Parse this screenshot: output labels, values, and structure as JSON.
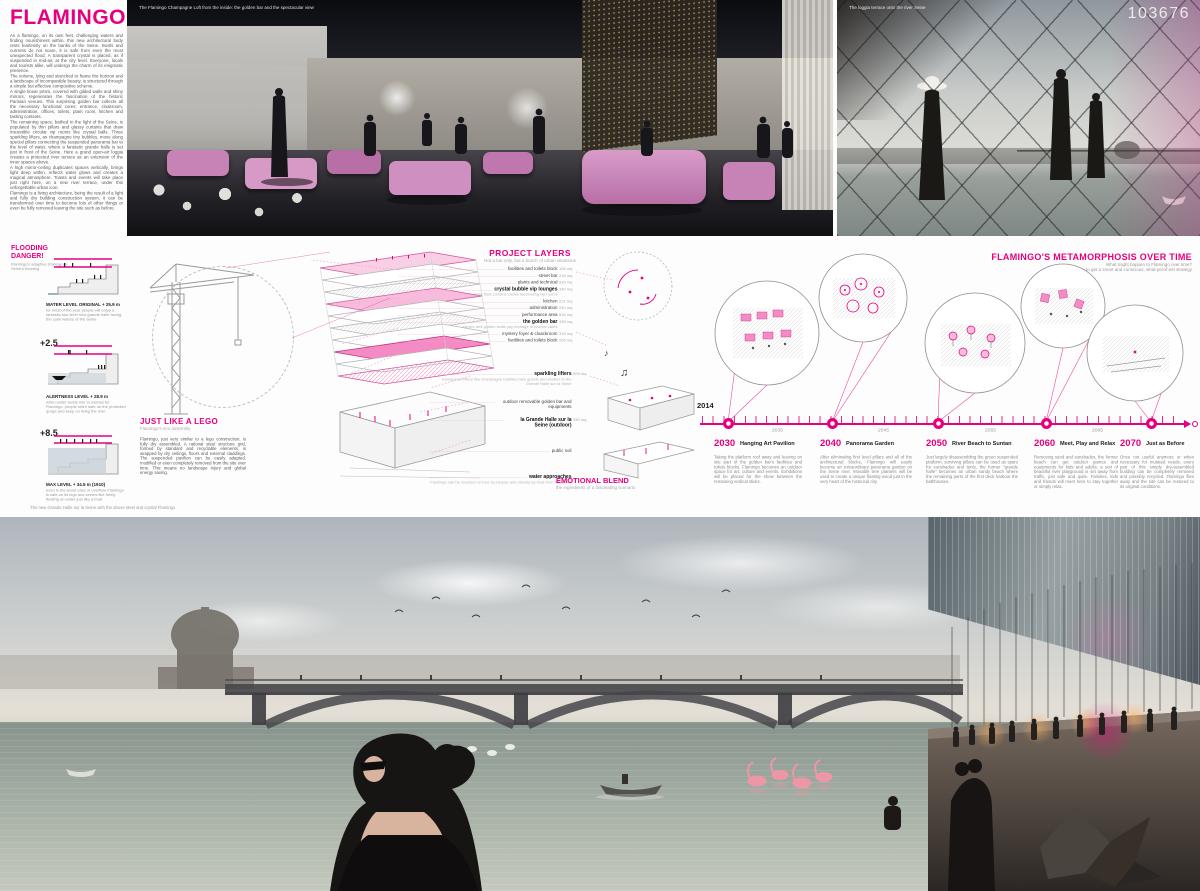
{
  "accent": "#e6007e",
  "board_number": "103676",
  "title": "FLAMINGO",
  "intro": {
    "p1": "As a flamingo, on its own feet, challenging waters and finding nourishment within, this new architectural body rests fearlessly on the banks of the Seine. Swirls and currents do not scare, it is safe from even the most unexpected flood. A transparent crystal is placed, as if suspended in mid-air, at the city level. Everyone, locals and tourists alike, will undergo the charm of its enigmatic presence.",
    "p2": "The volume, lying and stretched to frame the horizon and a landscape of incomparable beauty, is structured through a simple but effective compositive scheme.",
    "p3": "A single linear prism, covered with gilded walls and shiny mirrors, regenerates the fascination of the historic Parisian venues. This surprising golden bar collects all the necessary functional cores: entrance, cloakroom, administration, offices, toilets, plant room, kitchen and tasting contexts.",
    "p4": "The remaining space, bathed in the light of the Seine, is populated by thin pillars and glassy curtains that draw irresistible circular vip rooms like crystal balls. Three sparkling lifters, as champagne tiny bubbles, move along special pillars connecting the suspended panorama bar to the level of water, where a fantastic grande halle is set just in front of the Seine. Here a grand open-air loggia creates a protected river terrace as an extension of the inner spaces above.",
    "p5": "A high mirror-ceiling duplicates spaces vertically, brings light deep within, reflects water glows and creates a magical atmosphere. Toasts and events will take place just right here, on a new river terrace, under this unforgettable urban icon.",
    "p6": "Flamingo is a living architecture, being the result of a light and fully dry building construction system, it can be transformed over time to become lots of other things or even be fully removed leaving the site such as before."
  },
  "captions": {
    "loft": "The Flamingo Champagne Loft from the inside: the golden bar and the spectacular view",
    "terrace": "The loggia terrace onto the river Seine",
    "river": "The new Grande Halle sur la Seine with the above steel and crystal Flamingo"
  },
  "flooding": {
    "title": "FLOODING DANGER!",
    "subtitle": "Flamingo's adaptive strategy on Seine's flooding",
    "sections": [
      {
        "marker": "",
        "label": "WATER LEVEL ORIGINAL + 25.9 m",
        "text": "for most of the year people will enjoy a fantastic two-level new grande halle facing the calm waters of the Seine"
      },
      {
        "marker": "+2.5",
        "label": "ALERTNESS LEVEL + 28.9 m",
        "text": "when water levels rise to worries for Flamingo, people retire safe on the protected quays and keep on living the river"
      },
      {
        "marker": "+8.5",
        "label": "MAX LEVEL + 34.5 m (1910)",
        "text": "even in the worst case of overflow Flamingo is safe on its legs and seems like freely floating on water just like a boat"
      }
    ]
  },
  "lego": {
    "title": "JUST LIKE A LEGO",
    "subtitle": "Flamingo's eco assembly",
    "text": "Flamingo, just very similar to a lego construction, is fully dry assembled. A rational steel structure grid, formed by standard and recyclable elements, is wrapped by dry ceilings, floors and external claddings. The suspended pavilion can be easily adapted, modified or even completely removed from the site over time. This means no landscape injury and global energy saving."
  },
  "layers": {
    "title": "PROJECT LAYERS",
    "subtitle": "Not a bar only, but a bunch of urban situations",
    "items": [
      {
        "label": "facilities and toilets block",
        "value": "105 mq"
      },
      {
        "label": "street bar",
        "value": "218 mq"
      },
      {
        "label": "plants and technical",
        "value": "516 mq"
      },
      {
        "label": "crystal bubble vip lounges",
        "value": "340 mq",
        "sub": "glass float curtains create fascinating vip rooms"
      },
      {
        "label": "kitchen",
        "value": "221 mq"
      },
      {
        "label": "administration",
        "value": "240 mq"
      },
      {
        "label": "performance area",
        "value": "516 mq"
      },
      {
        "label": "the golden bar",
        "value": "435 mq",
        "sub": "mirrors and golden walls pay homage to historic cafés"
      },
      {
        "label": "mystery foyer & cloackroom",
        "value": "318 mq"
      },
      {
        "label": "facilities and toilets block",
        "value": "205 mq"
      }
    ],
    "lower_items": [
      {
        "label": "sparkling lifters",
        "value": "309 mq",
        "sub": "transparent lifters like champagne bubbles take guests and waiters to the Grande Halle sur la Seine"
      },
      {
        "label": "outdoor removable golden bar and equipments",
        "value": ""
      },
      {
        "label": "la Grande Halle sur la Seine (outdoor)",
        "value": "330 mq"
      },
      {
        "label": "public soil",
        "value": ""
      },
      {
        "label": "water approaches",
        "value": "",
        "sub": "Flamingo can be reached on foot, by bicycle and directly by boat from the Seine"
      }
    ]
  },
  "emotional": {
    "title": "EMOTIONAL BLEND",
    "subtitle": "the ingredients of a fascinating scenario"
  },
  "metamorphosis": {
    "title": "FLAMINGO'S METAMORPHOSIS OVER TIME",
    "subtitle1": "What might happen to Flamingo over time?",
    "subtitle2": "Let's try to get a smart and conscious, what-proof-est strategy",
    "start_year": "2014",
    "minor_years": [
      "2035",
      "2045",
      "2055",
      "2065"
    ],
    "milestones": [
      {
        "year": "2030",
        "title": "Hanging Art Pavilion",
        "text": "Taking the platform roof away and leaving on site part of the golden bar's facilities and toilets blocks, Flamingo becomes an outdoor space for art, culture and events. Exhibitions will be placed for the show between the remaining vertical sticks."
      },
      {
        "year": "2040",
        "title": "Panorama Garden",
        "text": "After eliminating first level pillars and all of the architectural blocks, Flamingo will easily become an extraordinary panorama garden on the Seine river. Movable tree planters will be used to create a unique floating wood just in the very heart of the historical city."
      },
      {
        "year": "2050",
        "title": "River Beach to Suntan",
        "text": "Just largely disassembling the green suspended platform, surviving pillars can be used as spars for sunshades and tents, the former \"grande halle\" becomes an urban sandy beach where the remaining parts of the first deck harbour the bathhouses."
      },
      {
        "year": "2060",
        "title": "Meet, Play and Relax",
        "text": "Removing sand and sunshades, the former beach can get outdoor games and equipments for kids and adults, a sort of beautiful river playground is set away from traffic, just safe and quite. Families, kids and friends will meet here to stay together or simply relax."
      },
      {
        "year": "2070",
        "title": "Just as Before",
        "text": "Once not useful anymore or when necessary for mutated needs, every part of this simply dry-assembled building can be completely removed and possibly recycled. Flamingo flies away and the site can be restored to its original conditions."
      }
    ]
  },
  "icons": {
    "music_note": "♪",
    "music_notes": "♫"
  }
}
